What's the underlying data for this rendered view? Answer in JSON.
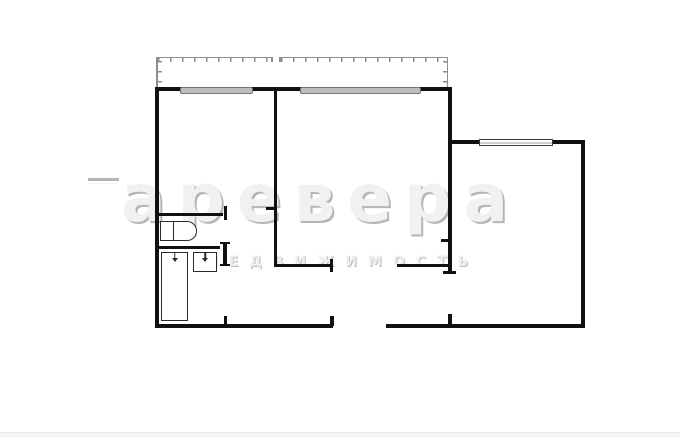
{
  "page": {
    "background": "#ffffff"
  },
  "watermark": {
    "brand_text": "аревера",
    "subtitle_text": "НЕДВИЖИМОСТЬ",
    "fill_color": "#f1f1f1",
    "shadow_color": "#b5b5b5"
  },
  "footer": {
    "background": "#f5f5f7"
  },
  "plan": {
    "wall_color": "#111111",
    "balcony_rail_color": "#8d8d8d",
    "window_fill_color": "#bdbdbd",
    "elements": [
      {
        "name": "balcony-rail-top-left",
        "kind": "rail-h",
        "x": 156,
        "y": 56.5,
        "w": 116,
        "h": 1.5
      },
      {
        "name": "balcony-rail-top-right",
        "kind": "rail-h",
        "x": 279,
        "y": 56.5,
        "w": 169,
        "h": 1.5
      },
      {
        "name": "balcony-ticks-top-left",
        "kind": "ticks-h",
        "x": 158,
        "y": 58,
        "w": 114,
        "h": 4
      },
      {
        "name": "balcony-ticks-top-right",
        "kind": "ticks-h",
        "x": 281,
        "y": 58,
        "w": 165,
        "h": 4
      },
      {
        "name": "balcony-rail-left",
        "kind": "rail-v",
        "x": 156,
        "y": 57,
        "w": 1.5,
        "h": 30
      },
      {
        "name": "balcony-rail-right",
        "kind": "rail-v",
        "x": 446.5,
        "y": 57,
        "w": 1.5,
        "h": 30
      },
      {
        "name": "balcony-ticks-left-v",
        "kind": "ticks-v",
        "x": 158,
        "y": 61,
        "w": 4,
        "h": 25
      },
      {
        "name": "balcony-ticks-right-v",
        "kind": "ticks-v",
        "x": 442.5,
        "y": 61,
        "w": 4,
        "h": 25
      },
      {
        "name": "balcony-gap-tick-left",
        "kind": "rail-v",
        "x": 271,
        "y": 57,
        "w": 1.5,
        "h": 5
      },
      {
        "name": "balcony-gap-tick-right",
        "kind": "rail-v",
        "x": 279,
        "y": 57,
        "w": 1.5,
        "h": 5
      },
      {
        "name": "wall-top",
        "kind": "wall",
        "x": 155,
        "y": 87,
        "w": 297,
        "h": 4
      },
      {
        "name": "wall-left",
        "kind": "wall",
        "x": 155,
        "y": 87,
        "w": 4,
        "h": 241
      },
      {
        "name": "wall-bottom-left",
        "kind": "wall",
        "x": 155,
        "y": 324,
        "w": 178,
        "h": 4
      },
      {
        "name": "wall-bottom-right",
        "kind": "wall",
        "x": 386,
        "y": 324,
        "w": 199,
        "h": 4
      },
      {
        "name": "wall-right-main",
        "kind": "wall",
        "x": 448,
        "y": 87,
        "w": 4,
        "h": 186
      },
      {
        "name": "wall-kitchen-top",
        "kind": "wall",
        "x": 450,
        "y": 140,
        "w": 134,
        "h": 3.5
      },
      {
        "name": "wall-right-outer",
        "kind": "wall",
        "x": 581,
        "y": 140,
        "w": 4,
        "h": 188
      },
      {
        "name": "window-1",
        "kind": "window-gray",
        "x": 180,
        "y": 86.5,
        "w": 73,
        "h": 7
      },
      {
        "name": "window-2",
        "kind": "window-gray",
        "x": 300,
        "y": 86.5,
        "w": 121,
        "h": 7
      },
      {
        "name": "window-3",
        "kind": "window-white",
        "x": 479,
        "y": 138.5,
        "w": 74,
        "h": 7
      },
      {
        "name": "wall-rooms-divider",
        "kind": "wall",
        "x": 273.5,
        "y": 87,
        "w": 3,
        "h": 180
      },
      {
        "name": "jamb-divider-door",
        "kind": "wall",
        "x": 266,
        "y": 207,
        "w": 8,
        "h": 2.5
      },
      {
        "name": "wall-wc-top",
        "kind": "wall",
        "x": 157,
        "y": 212.5,
        "w": 66,
        "h": 3
      },
      {
        "name": "jamb-wc-door",
        "kind": "wall",
        "x": 223.5,
        "y": 206,
        "w": 3.5,
        "h": 14
      },
      {
        "name": "wall-bath-top",
        "kind": "wall",
        "x": 157,
        "y": 245.5,
        "w": 63,
        "h": 3
      },
      {
        "name": "jamb-bath-cap-top",
        "kind": "wall",
        "x": 220,
        "y": 241.5,
        "w": 10,
        "h": 2.5
      },
      {
        "name": "wall-bath-right-stub",
        "kind": "wall",
        "x": 223,
        "y": 242,
        "w": 4,
        "h": 24
      },
      {
        "name": "jamb-bath-cap-bottom",
        "kind": "wall",
        "x": 220,
        "y": 263.5,
        "w": 10,
        "h": 2.5
      },
      {
        "name": "tick-bath-door-bottom",
        "kind": "wall",
        "x": 223.5,
        "y": 316,
        "w": 3.5,
        "h": 12
      },
      {
        "name": "wall-hall-left",
        "kind": "wall",
        "x": 275,
        "y": 263.5,
        "w": 57,
        "h": 3.5
      },
      {
        "name": "jamb-hall-door-left",
        "kind": "wall",
        "x": 329.5,
        "y": 259,
        "w": 3.5,
        "h": 13
      },
      {
        "name": "wall-hall-right",
        "kind": "wall",
        "x": 397,
        "y": 263.5,
        "w": 52,
        "h": 3.5
      },
      {
        "name": "tick-kitchen-wall",
        "kind": "wall",
        "x": 441,
        "y": 239,
        "w": 9,
        "h": 2.5
      },
      {
        "name": "jamb-kitchen-door-top",
        "kind": "wall",
        "x": 443,
        "y": 270.5,
        "w": 13,
        "h": 3
      },
      {
        "name": "tick-kitchen-door-bottom",
        "kind": "wall",
        "x": 448,
        "y": 314,
        "w": 3.5,
        "h": 12
      },
      {
        "name": "tick-entry-door-left",
        "kind": "wall",
        "x": 330,
        "y": 316,
        "w": 3.5,
        "h": 10
      },
      {
        "name": "bathtub",
        "kind": "fixture",
        "x": 161,
        "y": 252,
        "w": 27,
        "h": 69
      },
      {
        "name": "bathtub-tap",
        "kind": "tap",
        "x": 171.5,
        "y": 253,
        "w": 6,
        "h": 9
      },
      {
        "name": "sink",
        "kind": "fixture",
        "x": 193,
        "y": 252,
        "w": 24,
        "h": 20
      },
      {
        "name": "sink-tap",
        "kind": "tap",
        "x": 202,
        "y": 253,
        "w": 6,
        "h": 9
      },
      {
        "name": "toilet-tank",
        "kind": "fixture",
        "x": 160,
        "y": 221,
        "w": 14,
        "h": 20
      },
      {
        "name": "toilet-bowl",
        "kind": "toilet-bowl",
        "x": 174,
        "y": 221,
        "w": 23,
        "h": 20
      }
    ]
  }
}
